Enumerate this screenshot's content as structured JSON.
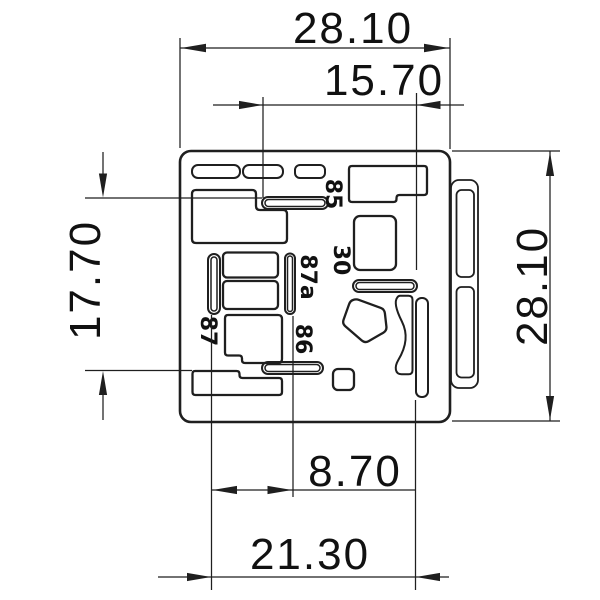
{
  "dimensions": {
    "overall_width": "28.10",
    "upper_slot_width": "15.70",
    "left_height": "17.70",
    "overall_height": "28.10",
    "lower_inner_width": "8.70",
    "lower_width": "21.30"
  },
  "terminals": {
    "t85": "85",
    "t30": "30",
    "t87a": "87a",
    "t87": "87",
    "t86": "86"
  },
  "colors": {
    "line": "#1f1f1f",
    "text": "#111111",
    "background": "#ffffff"
  }
}
